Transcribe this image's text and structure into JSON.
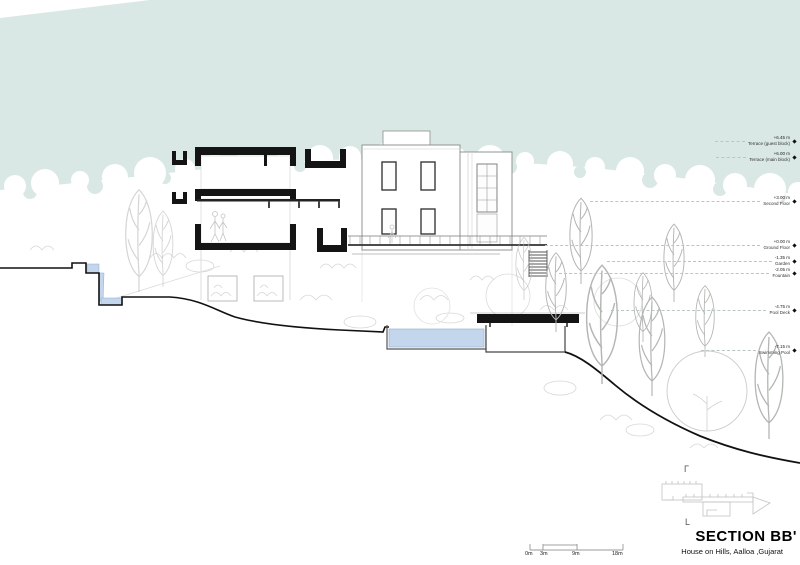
{
  "drawing": {
    "title": "SECTION BB'",
    "subtitle": "House on Hills, Aalloa ,Gujarat"
  },
  "levels": [
    {
      "elevation": "+6.45 m",
      "name": "Terrace (guest block)"
    },
    {
      "elevation": "+6.00 m",
      "name": "Terrace (main block)"
    },
    {
      "elevation": "+3.00 m",
      "name": "Second Floor"
    },
    {
      "elevation": "+0.00 m",
      "name": "Ground Floor"
    },
    {
      "elevation": "-1.35 m",
      "name": "Garden"
    },
    {
      "elevation": "-2.05 m",
      "name": "Fountain"
    },
    {
      "elevation": "-4.75 m",
      "name": "Pool Deck"
    },
    {
      "elevation": "-7.15 m",
      "name": "Swimming Pool"
    }
  ],
  "scale_bar": {
    "labels": [
      "0m",
      "3m",
      "9m",
      "18m"
    ]
  },
  "key_plan": {
    "mark_top": "Γ",
    "mark_bottom": "L"
  },
  "icons": {
    "level_marker": "diamond"
  },
  "colors": {
    "sky": "#d9e8e5",
    "water": "#c3d6ec",
    "poche": "#141414",
    "sketch": "#c3c8c2"
  }
}
